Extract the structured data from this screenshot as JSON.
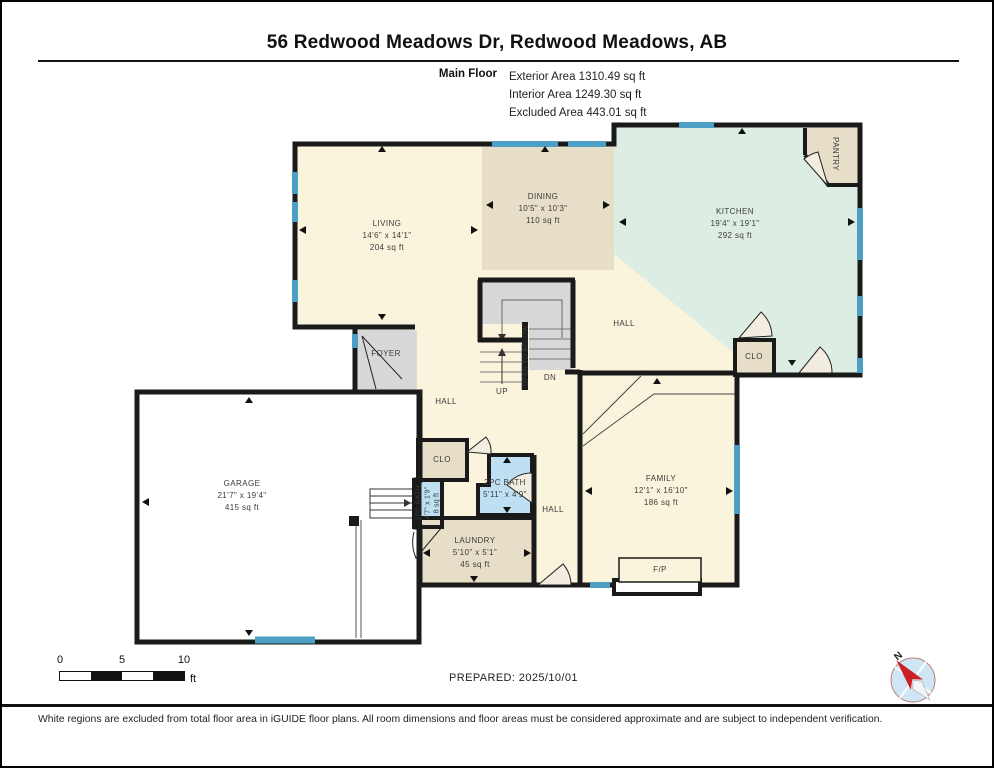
{
  "header": {
    "title": "56 Redwood Meadows Dr, Redwood Meadows, AB",
    "floor_label": "Main Floor",
    "exterior_area": "Exterior Area 1310.49 sq ft",
    "interior_area": "Interior Area 1249.30 sq ft",
    "excluded_area": "Excluded Area 443.01 sq ft"
  },
  "rooms": {
    "living": {
      "name": "LIVING",
      "dims": "14'6\" x 14'1\"",
      "area": "204 sq ft"
    },
    "dining": {
      "name": "DINING",
      "dims": "10'5\" x 10'3\"",
      "area": "110 sq ft"
    },
    "kitchen": {
      "name": "KITCHEN",
      "dims": "19'4\" x 19'1\"",
      "area": "292 sq ft"
    },
    "family": {
      "name": "FAMILY",
      "dims": "12'1\" x 16'10\"",
      "area": "186 sq ft"
    },
    "garage": {
      "name": "GARAGE",
      "dims": "21'7\" x 19'4\"",
      "area": "415 sq ft"
    },
    "laundry": {
      "name": "LAUNDRY",
      "dims": "5'10\" x 5'1\"",
      "area": "45 sq ft"
    },
    "bath_2pc": {
      "name": "2PC BATH",
      "dims": "5'11\" x 4'9\""
    },
    "bath_1pc": {
      "name": "1PC BATH",
      "dims": "4'7\" x 1'9\"",
      "area": "8 sq ft"
    },
    "pantry": {
      "name": "PANTRY"
    },
    "foyer": {
      "name": "FOYER"
    },
    "clo_kitchen": {
      "name": "CLO"
    },
    "clo_hall": {
      "name": "CLO"
    },
    "hall_upper": {
      "name": "HALL"
    },
    "hall_left": {
      "name": "HALL"
    },
    "hall_lower": {
      "name": "HALL"
    },
    "fireplace": {
      "name": "F/P"
    },
    "stairs": {
      "up": "UP",
      "dn": "DN",
      "open_to_below": "OPEN TO BELOW"
    }
  },
  "scale_bar": {
    "ticks": [
      "0",
      "5",
      "10"
    ],
    "unit": "ft"
  },
  "compass": {
    "north": "N"
  },
  "footer": {
    "prepared": "PREPARED: 2025/10/01",
    "disclaimer": "White regions are excluded from total floor area in iGUIDE floor plans. All room dimensions and floor areas must be considered approximate and are subject to independent verification."
  },
  "colors": {
    "wall": "#1a1a1a",
    "window": "#4d9fc6",
    "room_cream": "#fbf4dc",
    "room_tan": "#e7dec8",
    "room_green": "#deede4",
    "room_blue": "#bee0f2",
    "room_gray": "#d8d8d8",
    "excluded_white": "#ffffff",
    "compass_needle": "#cc2027",
    "compass_face": "#cfe7f4"
  }
}
